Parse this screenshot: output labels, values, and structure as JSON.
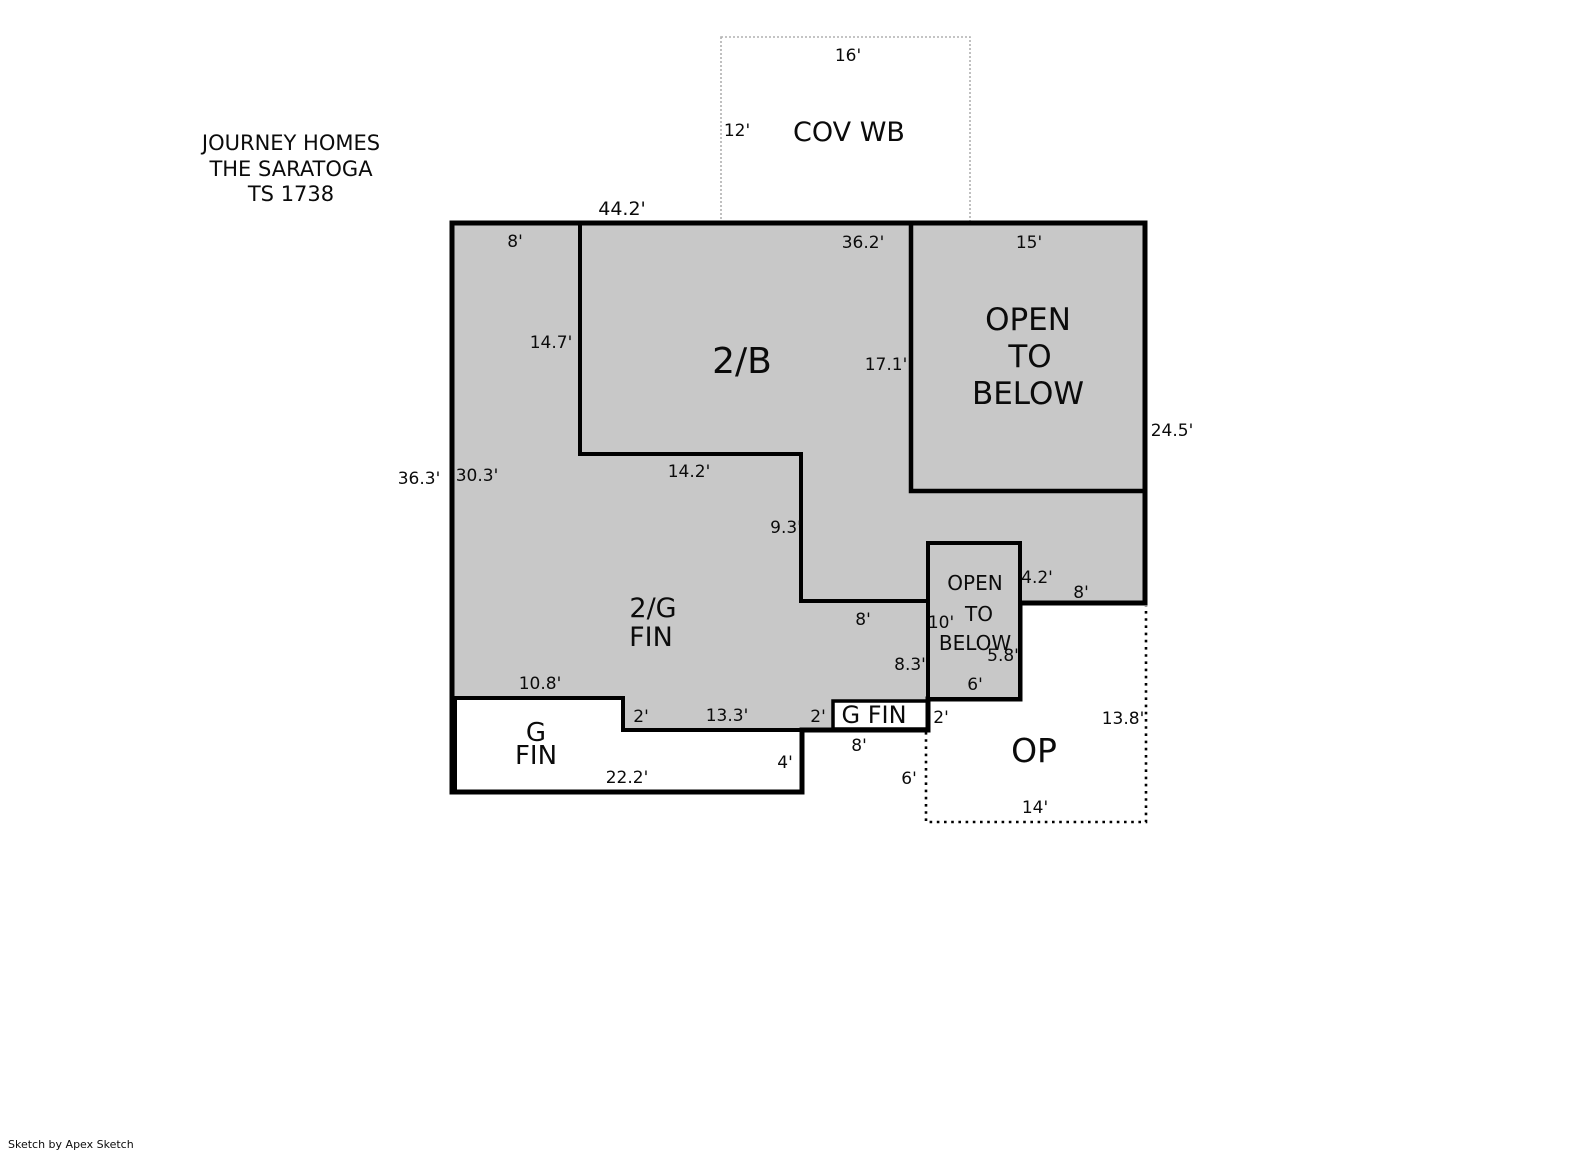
{
  "title": {
    "line1": "JOURNEY HOMES",
    "line2": "THE SARATOGA",
    "line3": "TS 1738"
  },
  "footer": {
    "credit": "Sketch by Apex Sketch"
  },
  "colors": {
    "area_fill": "#c8c8c8",
    "outline": "#000000",
    "cov_border": "#b0b0b0"
  },
  "areas": {
    "cov_wb": {
      "label": "COV WB"
    },
    "two_b": {
      "label": "2/B"
    },
    "open_to_below_large": {
      "line1": "OPEN",
      "line2": "TO",
      "line3": "BELOW"
    },
    "two_g_fin": {
      "line1": "2/G",
      "line2": "FIN"
    },
    "open_to_below_small": {
      "line1": "OPEN",
      "line2": "TO",
      "line3": "BELOW"
    },
    "g_fin_large": {
      "line1": "G",
      "line2": "FIN"
    },
    "g_fin_small": {
      "label": "G FIN"
    },
    "op": {
      "label": "OP"
    }
  },
  "dimensions": {
    "cov_top": "16'",
    "cov_left": "12'",
    "top_total": "44.2'",
    "top_left": "8'",
    "top_right": "36.2'",
    "otb_top": "15'",
    "left_total": "36.3'",
    "left_upper": "30.3'",
    "step_v1": "14.7'",
    "otb_left": "17.1'",
    "right_upper": "24.5'",
    "step_h1": "14.2'",
    "step_v2": "9.3'",
    "step_h2": "8'",
    "sotb_right_upper": "4.2'",
    "right_lower": "8'",
    "sotb_left": "10'",
    "sotb_right_lower": "5.8'",
    "gfin2_right": "8.3'",
    "sotb_bottom": "6'",
    "gfin_top": "10.8'",
    "notch_left": "2'",
    "notch_bottom": "13.3'",
    "gfin_small_left": "2'",
    "gfin_small_right": "2'",
    "gfin_small_bottom": "8'",
    "gfin_bottom": "22.2'",
    "gfin_right": "4'",
    "op_left": "6'",
    "op_right": "13.8'",
    "op_bottom": "14'"
  }
}
